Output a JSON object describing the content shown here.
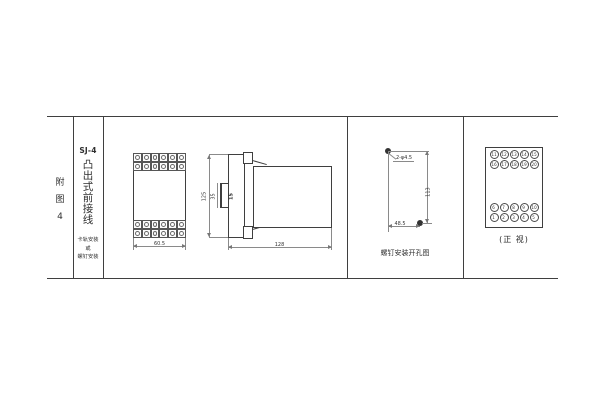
{
  "colors": {
    "paper": "#ffffff",
    "frame_line": "#3f3f3f",
    "dim_line": "#8a8a8a",
    "ink": "#2f2f2f"
  },
  "title_block": {
    "figure_label_chars": [
      "附",
      "图",
      "4"
    ],
    "model": "SJ-4",
    "type_chars": [
      "凸",
      "出",
      "式",
      "前",
      "接",
      "线"
    ],
    "mount_note_lines": [
      "卡轨安装",
      "或",
      "螺钉安装"
    ]
  },
  "front_view": {
    "width_dim": "60.5",
    "terminal_rows": 2,
    "terminal_cols": 6
  },
  "side_view": {
    "height_dim": "125",
    "depth_dim": "128",
    "rail_dim": "35",
    "clip_dim": "15"
  },
  "drill_view": {
    "hole_label": "2-φ4.5",
    "vertical_dim": "113",
    "horizontal_dim": "48.5",
    "caption": "螺钉安装开孔图"
  },
  "panel_view": {
    "caption": "(正 视)",
    "top_rows": [
      [
        11,
        12,
        13,
        14,
        15
      ],
      [
        16,
        17,
        18,
        19,
        20
      ]
    ],
    "bottom_rows": [
      [
        6,
        7,
        8,
        9,
        10
      ],
      [
        1,
        2,
        3,
        4,
        5
      ]
    ]
  }
}
